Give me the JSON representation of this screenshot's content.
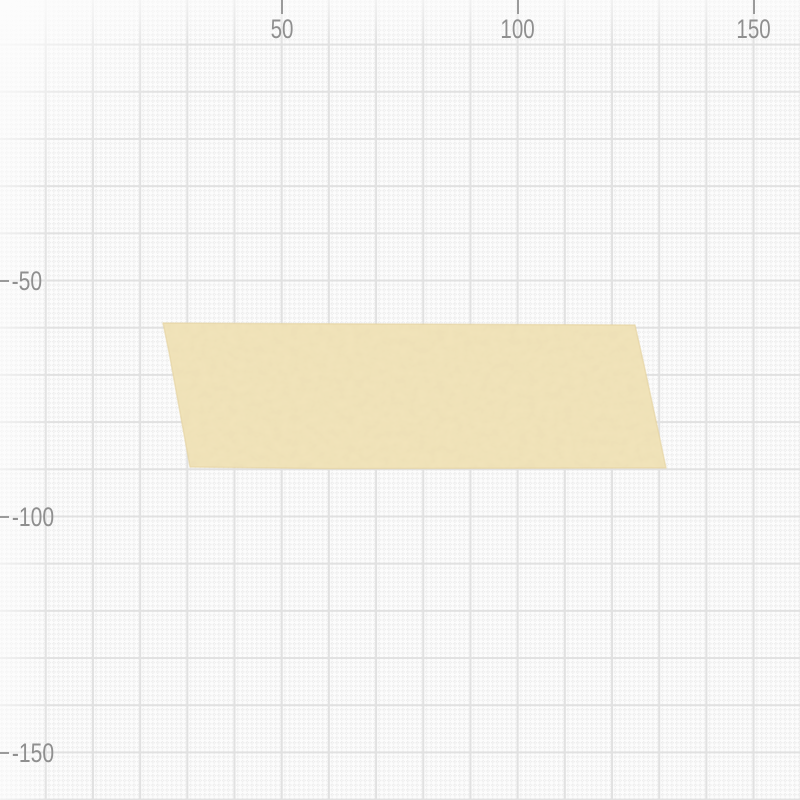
{
  "app": {
    "view": "grid-canvas"
  },
  "canvas": {
    "background_color": "#fcfcfc",
    "grid": {
      "major_spacing_px": 47.2,
      "minor_spacing_px": 4.72,
      "units_per_major_cell": 10,
      "major_line_color": "#e1e1e1",
      "minor_dot_color": "#e9e9e9"
    }
  },
  "rulers": {
    "label_color": "#8f8f8f",
    "tick_color": "#9a9a9a",
    "x_axis": {
      "ticks": [
        {
          "label": "50",
          "x_px": 282
        },
        {
          "label": "100",
          "x_px": 518
        },
        {
          "label": "150",
          "x_px": 754
        }
      ]
    },
    "y_axis": {
      "ticks": [
        {
          "label": "-50",
          "y_px": 281
        },
        {
          "label": "-100",
          "y_px": 517
        },
        {
          "label": "-150",
          "y_px": 753
        }
      ]
    }
  },
  "objects": [
    {
      "name": "tape-shape",
      "kind": "paper-tape-quadrilateral",
      "fill_color": "#f2e4ba",
      "edge_color": "#e6d4a0",
      "points": "163,323 320,323.8 480,324.4 635,325 644,365 658,430 666,468 500,468.3 330,468.6 190,467 169,352",
      "bounds": {
        "left_px": 163,
        "top_px": 323,
        "right_px": 666,
        "bottom_px": 468
      }
    }
  ]
}
